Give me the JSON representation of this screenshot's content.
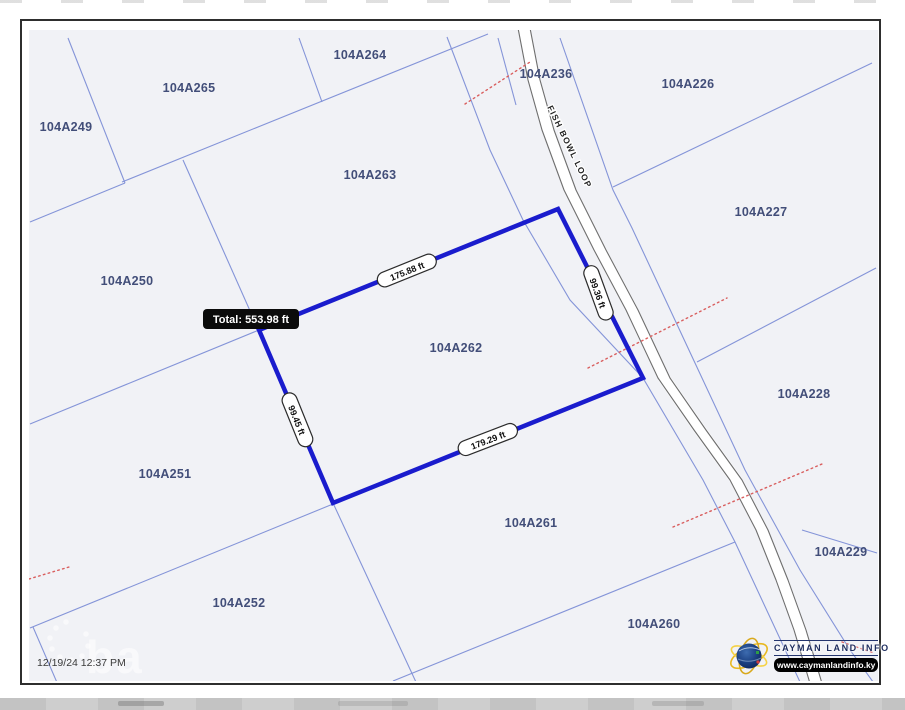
{
  "map": {
    "timestamp": "12/19/24 12:37 PM",
    "road": {
      "name": "FISH BOWL LOOP",
      "label_x": 567,
      "label_y": 148,
      "label_angle": 64,
      "center": [
        [
          524,
          28
        ],
        [
          534,
          80
        ],
        [
          548,
          130
        ],
        [
          570,
          190
        ],
        [
          600,
          250
        ],
        [
          632,
          310
        ],
        [
          664,
          378
        ],
        [
          700,
          430
        ],
        [
          736,
          480
        ],
        [
          762,
          530
        ],
        [
          782,
          580
        ],
        [
          800,
          630
        ],
        [
          815,
          680
        ],
        [
          823,
          714
        ]
      ]
    },
    "parcels": [
      {
        "id": "104A264",
        "x": 360,
        "y": 59
      },
      {
        "id": "104A265",
        "x": 189,
        "y": 92
      },
      {
        "id": "104A249",
        "x": 66,
        "y": 131
      },
      {
        "id": "104A263",
        "x": 370,
        "y": 179
      },
      {
        "id": "104A236",
        "x": 546,
        "y": 78
      },
      {
        "id": "104A226",
        "x": 688,
        "y": 88
      },
      {
        "id": "104A227",
        "x": 761,
        "y": 216
      },
      {
        "id": "104A250",
        "x": 127,
        "y": 285
      },
      {
        "id": "104A228",
        "x": 804,
        "y": 398
      },
      {
        "id": "104A251",
        "x": 165,
        "y": 478
      },
      {
        "id": "104A229",
        "x": 841,
        "y": 556
      },
      {
        "id": "104A261",
        "x": 531,
        "y": 527
      },
      {
        "id": "104A252",
        "x": 239,
        "y": 607
      },
      {
        "id": "104A260",
        "x": 654,
        "y": 628
      }
    ],
    "selected": {
      "id": "104A262",
      "label_x": 456,
      "label_y": 352,
      "points": [
        [
          259,
          330
        ],
        [
          558,
          209
        ],
        [
          643,
          378
        ],
        [
          333,
          503
        ]
      ],
      "measurements": [
        {
          "text": "175.88 ft",
          "x": 407,
          "y": 271,
          "angle": -22
        },
        {
          "text": "99.36 ft",
          "x": 598,
          "y": 293,
          "angle": 70
        },
        {
          "text": "179.29 ft",
          "x": 488,
          "y": 440,
          "angle": -21
        },
        {
          "text": "99.45 ft",
          "x": 297,
          "y": 420,
          "angle": 68
        }
      ],
      "tooltip": {
        "text": "Total: 553.98 ft",
        "x": 203,
        "y": 309
      }
    },
    "boundaries": [
      [
        [
          68,
          38
        ],
        [
          125,
          183
        ]
      ],
      [
        [
          125,
          183
        ],
        [
          30,
          222
        ]
      ],
      [
        [
          122,
          182
        ],
        [
          488,
          34
        ]
      ],
      [
        [
          299,
          38
        ],
        [
          322,
          102
        ]
      ],
      [
        [
          183,
          160
        ],
        [
          259,
          331
        ]
      ],
      [
        [
          333,
          503
        ],
        [
          428,
          708
        ]
      ],
      [
        [
          259,
          330
        ],
        [
          30,
          424
        ]
      ],
      [
        [
          333,
          504
        ],
        [
          30,
          628
        ]
      ],
      [
        [
          33,
          627
        ],
        [
          68,
          708
        ]
      ],
      [
        [
          447,
          37
        ],
        [
          490,
          150
        ],
        [
          523,
          220
        ],
        [
          570,
          300
        ],
        [
          643,
          378
        ],
        [
          703,
          480
        ],
        [
          735,
          542
        ],
        [
          782,
          643
        ],
        [
          812,
          708
        ]
      ],
      [
        [
          560,
          38
        ],
        [
          613,
          190
        ],
        [
          632,
          228
        ],
        [
          695,
          363
        ],
        [
          745,
          470
        ],
        [
          800,
          570
        ],
        [
          850,
          650
        ],
        [
          876,
          686
        ]
      ],
      [
        [
          613,
          187
        ],
        [
          872,
          63
        ]
      ],
      [
        [
          697,
          362
        ],
        [
          876,
          268
        ]
      ],
      [
        [
          802,
          530
        ],
        [
          877,
          553
        ]
      ],
      [
        [
          393,
          681
        ],
        [
          735,
          542
        ]
      ],
      [
        [
          498,
          38
        ],
        [
          516,
          105
        ]
      ]
    ],
    "red_lines": [
      [
        [
          465,
          104
        ],
        [
          530,
          62
        ]
      ],
      [
        [
          588,
          368
        ],
        [
          727,
          298
        ]
      ],
      [
        [
          673,
          527
        ],
        [
          822,
          464
        ]
      ],
      [
        [
          29,
          579
        ],
        [
          69,
          567
        ]
      ],
      [
        [
          842,
          642
        ],
        [
          874,
          653
        ]
      ]
    ]
  },
  "branding": {
    "title": "CAYMAN LAND INFO",
    "url": "www.caymanlandinfo.ky",
    "watermark": "ba"
  },
  "colors": {
    "boundary": "#8494d8",
    "selected_parcel": "#1a1ccd",
    "red_dotted": "#d95f5f",
    "road_casing": "#6e6e6e",
    "parcel_label": "#424e79"
  }
}
